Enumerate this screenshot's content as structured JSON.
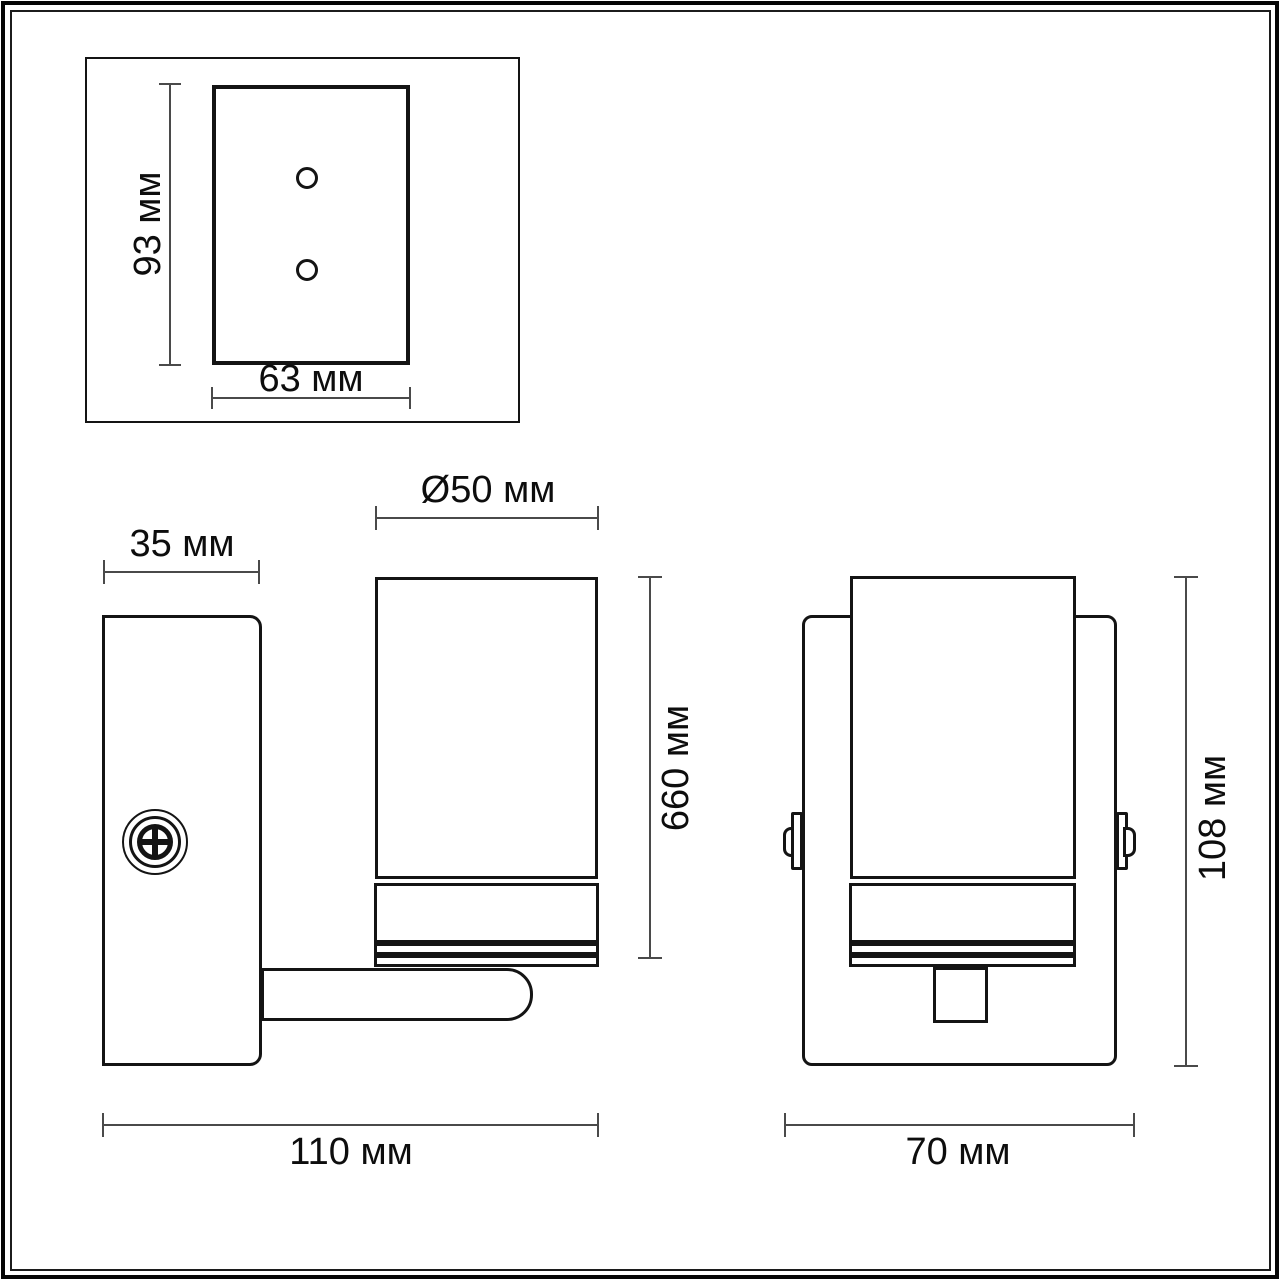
{
  "drawing": {
    "title": "wall-lamp-dimension-drawing",
    "units": "мм",
    "colors": {
      "outline": "#141414",
      "dimension_line": "#4a4a4a",
      "background": "#ffffff"
    },
    "mounting_plate_view": {
      "height_label": "93 мм",
      "width_label": "63 мм",
      "hole_count": 2
    },
    "side_view": {
      "plate_depth_label": "35 мм",
      "shade_diameter_label": "Ø50 мм",
      "body_height_label": "660 мм",
      "total_depth_label": "110 мм"
    },
    "front_view": {
      "total_width_label": "70 мм",
      "total_height_label": "108 мм"
    }
  }
}
